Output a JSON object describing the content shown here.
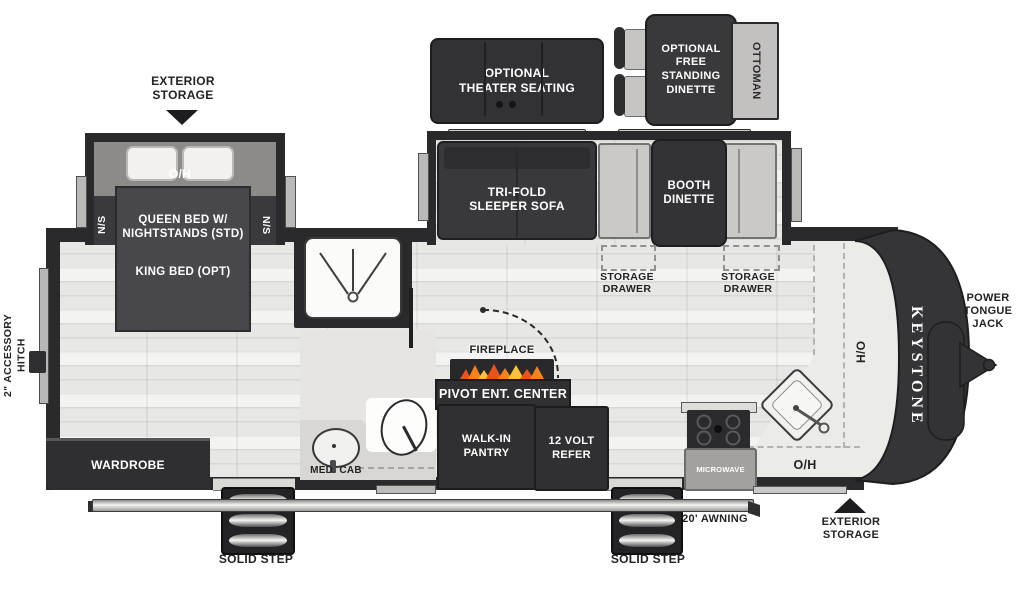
{
  "drawing": {
    "brand": "KEYSTONE",
    "front_label": "POWER\nTONGUE\nJACK",
    "hitch_label": "2\" ACCESSORY\nHITCH",
    "exterior_storage_front": "EXTERIOR\nSTORAGE",
    "exterior_storage_rear": "EXTERIOR\nSTORAGE",
    "awning_label": "20' AWNING",
    "step_label_left": "SOLID STEP",
    "step_label_right": "SOLID STEP"
  },
  "optional": {
    "theater_seating": "OPTIONAL\nTHEATER SEATING",
    "free_standing_dinette": "OPTIONAL\nFREE\nSTANDING\nDINETTE",
    "ottoman": "OTTOMAN"
  },
  "bedroom": {
    "overhead": "O/H",
    "nightstand_left": "N/S",
    "nightstand_right": "N/S",
    "bed_standard": "QUEEN BED W/\nNIGHTSTANDS (STD)",
    "bed_option": "KING BED (OPT)",
    "wardrobe": "WARDROBE"
  },
  "living": {
    "sofa": "TRI-FOLD\nSLEEPER SOFA",
    "booth_dinette": "BOOTH\nDINETTE",
    "storage_drawer_left": "STORAGE\nDRAWER",
    "storage_drawer_right": "STORAGE\nDRAWER",
    "fireplace": "FIREPLACE",
    "entertainment_center": "PIVOT ENT. CENTER"
  },
  "kitchen": {
    "pantry": "WALK-IN\nPANTRY",
    "refrigerator": "12 VOLT\nREFER",
    "microwave": "MICROWAVE",
    "overhead": "O/H",
    "hutch_overhead": "H/O"
  },
  "bathroom": {
    "medicine_cabinet": "MED. CAB"
  },
  "colors": {
    "wall": "#2a2a2c",
    "furniture_dark": "#323234",
    "bench": "#cbc9c7",
    "floor": "#e7e7e5",
    "flame_orange": "#f5821f",
    "flame_red": "#e8541d",
    "flame_yellow": "#ffc23c"
  }
}
